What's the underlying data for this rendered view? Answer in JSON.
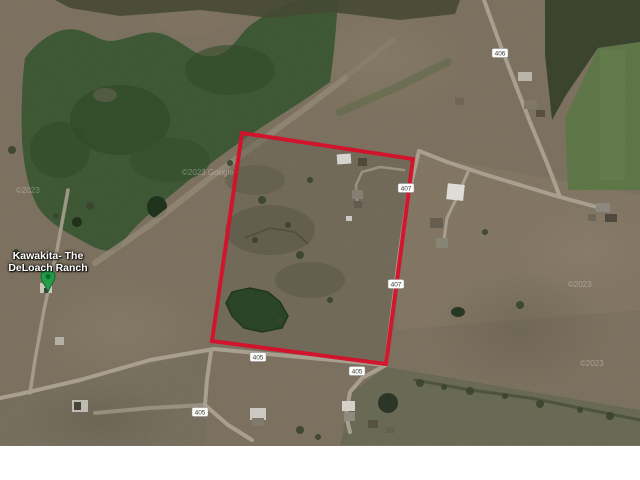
{
  "map": {
    "place_label": {
      "line1": "Kawakita- The",
      "line2": "DeLoach Ranch"
    },
    "marker": {
      "type": "green-map-pin",
      "color": "#259b48"
    },
    "boundary": {
      "color": "#e8112d",
      "points_attr": "242,133 413,159 386,364 212,341"
    },
    "road_labels": [
      {
        "text": "406"
      },
      {
        "text": "407"
      },
      {
        "text": "407"
      },
      {
        "text": "405"
      },
      {
        "text": "405"
      },
      {
        "text": "405"
      }
    ],
    "watermarks": [
      {
        "text": "©2023"
      },
      {
        "text": "©2023 Google"
      },
      {
        "text": "©2023"
      },
      {
        "text": "©2023"
      }
    ],
    "colors": {
      "field": "#877b68",
      "woods_water": "#44603a",
      "pasture_green": "#66804e",
      "road": "#b6ad9c",
      "letterbox": "#ffffff"
    }
  }
}
